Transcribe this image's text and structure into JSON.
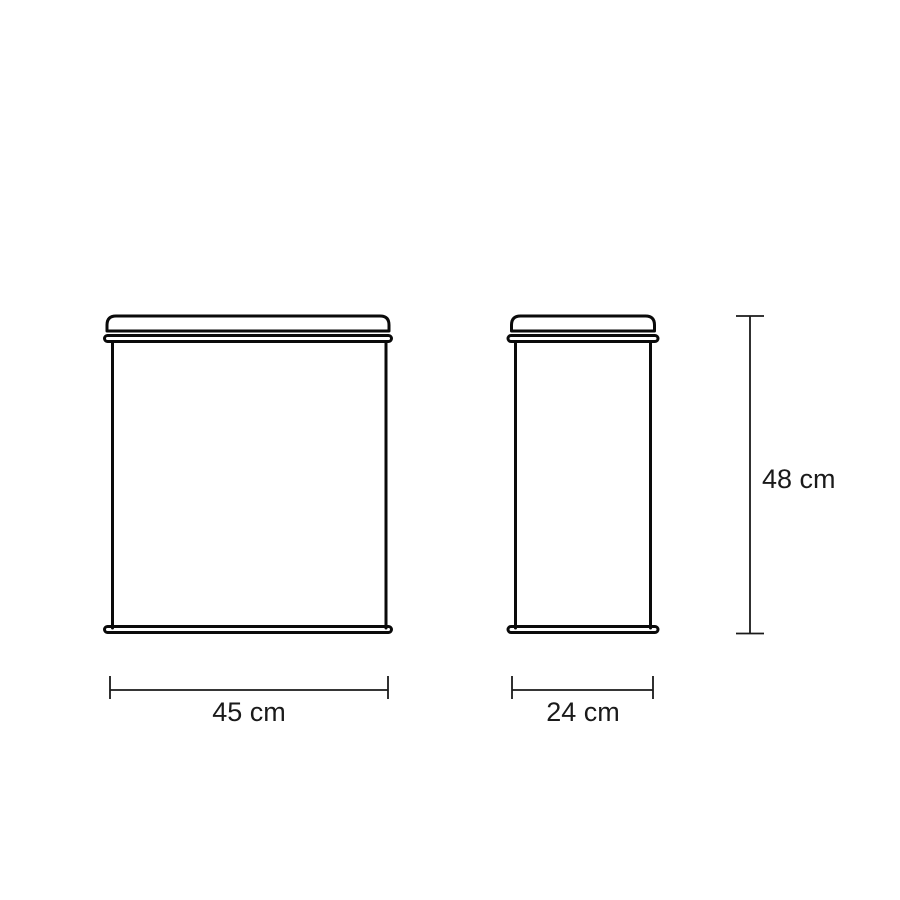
{
  "diagram": {
    "kind": "product-dimension-drawing",
    "views": [
      {
        "id": "front-view",
        "description": "front elevation of lidded container"
      },
      {
        "id": "side-view",
        "description": "side elevation of lidded container"
      }
    ]
  },
  "dimensions": {
    "width": {
      "label": "45 cm",
      "value": 45,
      "unit": "cm"
    },
    "depth": {
      "label": "24 cm",
      "value": 24,
      "unit": "cm"
    },
    "height": {
      "label": "48 cm",
      "value": 48,
      "unit": "cm"
    }
  },
  "colors": {
    "background": "#ffffff",
    "outline": "#0a0a0a",
    "dimension": "#1a1a1a"
  }
}
